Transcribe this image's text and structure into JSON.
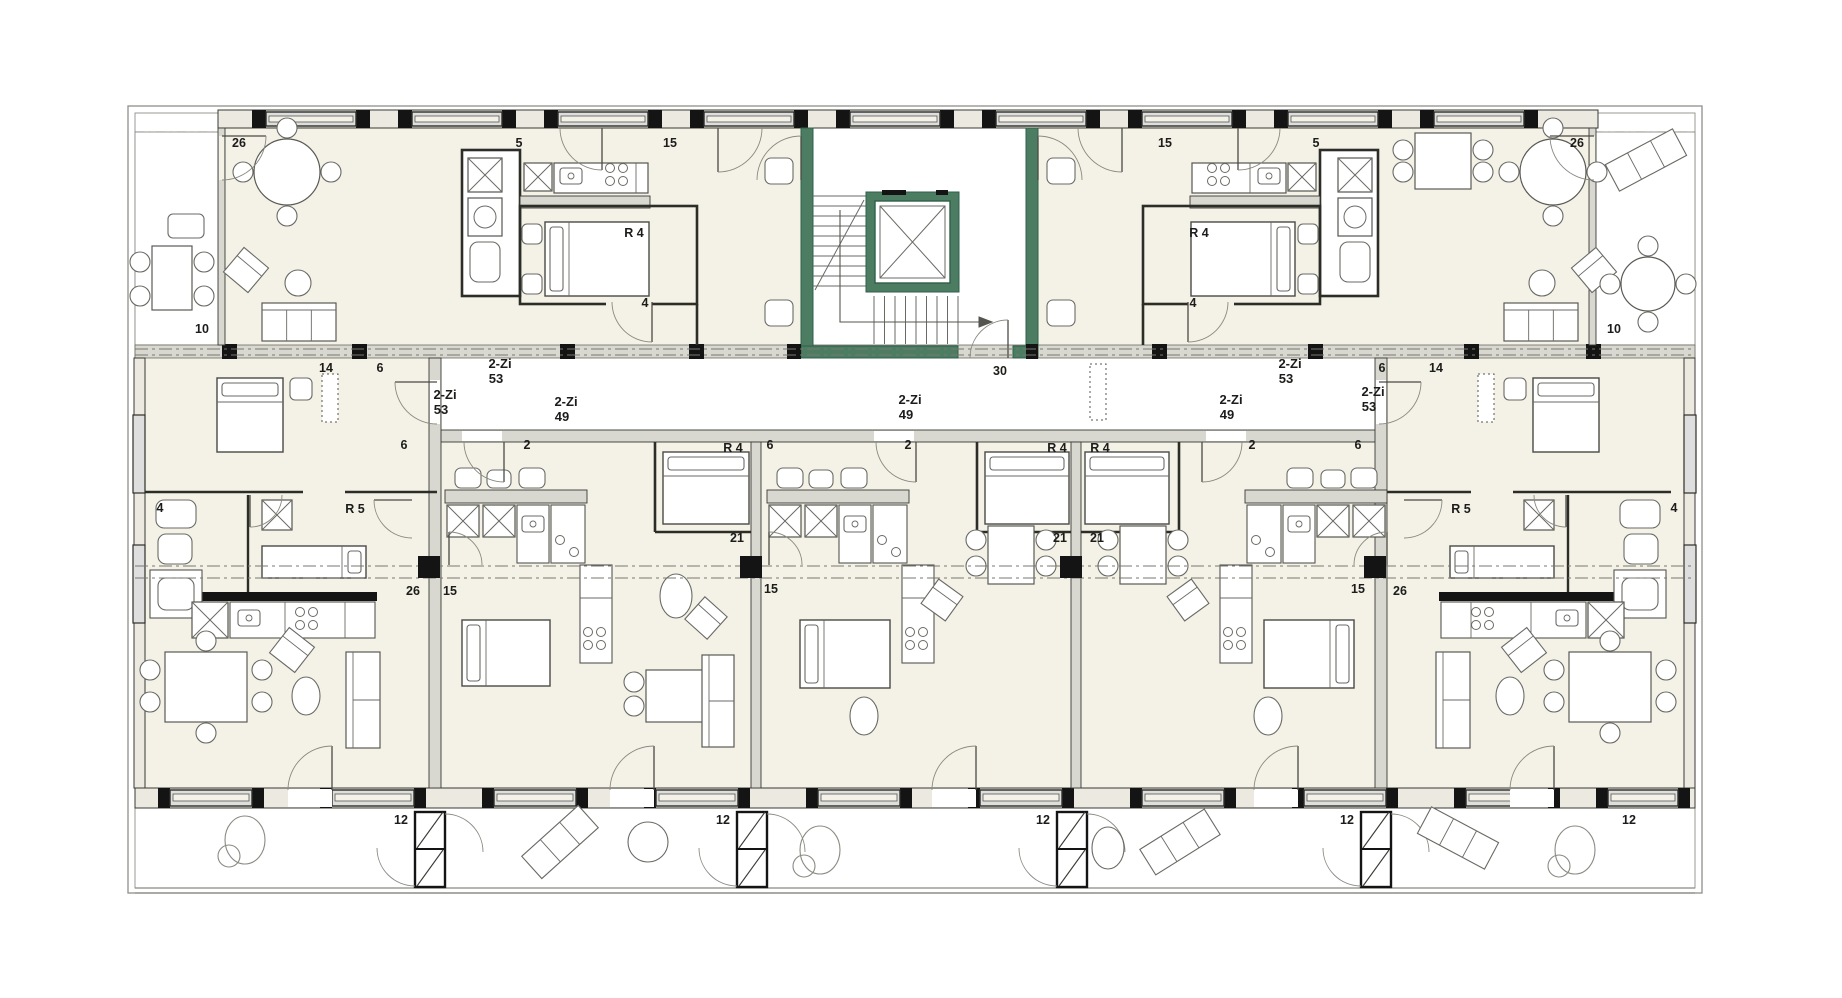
{
  "palette": {
    "background": "#ffffff",
    "room_fill": "#f4f2e7",
    "wall_fill": "#d8d8d0",
    "window_band": "#eceae0",
    "window_glass": "#dededf",
    "stair_green": "#4c7d62",
    "stair_green_dark": "#2f5f48",
    "line_dark": "#2d2d28",
    "line_medium": "#55554f",
    "furniture_line": "#6a6a64",
    "dash_gray": "#77776f",
    "black": "#141414",
    "label_color": "#1c1c1a"
  },
  "labels": {
    "units": [
      {
        "type": "2-Zi",
        "area": "53",
        "x": 500,
        "y": 368
      },
      {
        "type": "2-Zi",
        "area": "53",
        "x": 1290,
        "y": 368
      },
      {
        "type": "2-Zi",
        "area": "53",
        "x": 445,
        "y": 399
      },
      {
        "type": "2-Zi",
        "area": "49",
        "x": 566,
        "y": 406
      },
      {
        "type": "2-Zi",
        "area": "49",
        "x": 910,
        "y": 404
      },
      {
        "type": "2-Zi",
        "area": "49",
        "x": 1231,
        "y": 404
      },
      {
        "type": "2-Zi",
        "area": "53",
        "x": 1373,
        "y": 396
      }
    ],
    "rooms": [
      {
        "text": "R 4",
        "x": 634,
        "y": 237
      },
      {
        "text": "R 4",
        "x": 1199,
        "y": 237
      },
      {
        "text": "R 4",
        "x": 733,
        "y": 452
      },
      {
        "text": "R 4",
        "x": 1057,
        "y": 452
      },
      {
        "text": "R 4",
        "x": 1100,
        "y": 452
      },
      {
        "text": "R 5",
        "x": 355,
        "y": 513
      },
      {
        "text": "R 5",
        "x": 1461,
        "y": 513
      }
    ],
    "dims": [
      {
        "text": "26",
        "x": 239,
        "y": 147
      },
      {
        "text": "5",
        "x": 519,
        "y": 147
      },
      {
        "text": "15",
        "x": 670,
        "y": 147
      },
      {
        "text": "15",
        "x": 1165,
        "y": 147
      },
      {
        "text": "5",
        "x": 1316,
        "y": 147
      },
      {
        "text": "26",
        "x": 1577,
        "y": 147
      },
      {
        "text": "4",
        "x": 645,
        "y": 307
      },
      {
        "text": "4",
        "x": 1193,
        "y": 307
      },
      {
        "text": "10",
        "x": 202,
        "y": 333
      },
      {
        "text": "10",
        "x": 1614,
        "y": 333
      },
      {
        "text": "14",
        "x": 326,
        "y": 372
      },
      {
        "text": "6",
        "x": 380,
        "y": 372
      },
      {
        "text": "6",
        "x": 1382,
        "y": 372
      },
      {
        "text": "14",
        "x": 1436,
        "y": 372
      },
      {
        "text": "30",
        "x": 1000,
        "y": 375
      },
      {
        "text": "6",
        "x": 404,
        "y": 449
      },
      {
        "text": "2",
        "x": 527,
        "y": 449
      },
      {
        "text": "6",
        "x": 770,
        "y": 449
      },
      {
        "text": "2",
        "x": 908,
        "y": 449
      },
      {
        "text": "2",
        "x": 1252,
        "y": 449
      },
      {
        "text": "6",
        "x": 1358,
        "y": 449
      },
      {
        "text": "4",
        "x": 160,
        "y": 512
      },
      {
        "text": "4",
        "x": 1674,
        "y": 512
      },
      {
        "text": "21",
        "x": 737,
        "y": 542
      },
      {
        "text": "21",
        "x": 1060,
        "y": 542
      },
      {
        "text": "21",
        "x": 1097,
        "y": 542
      },
      {
        "text": "26",
        "x": 413,
        "y": 595
      },
      {
        "text": "15",
        "x": 450,
        "y": 595
      },
      {
        "text": "15",
        "x": 771,
        "y": 593
      },
      {
        "text": "15",
        "x": 1358,
        "y": 593
      },
      {
        "text": "26",
        "x": 1400,
        "y": 595
      },
      {
        "text": "12",
        "x": 401,
        "y": 824
      },
      {
        "text": "12",
        "x": 723,
        "y": 824
      },
      {
        "text": "12",
        "x": 1043,
        "y": 824
      },
      {
        "text": "12",
        "x": 1347,
        "y": 824
      },
      {
        "text": "12",
        "x": 1629,
        "y": 824
      }
    ]
  }
}
